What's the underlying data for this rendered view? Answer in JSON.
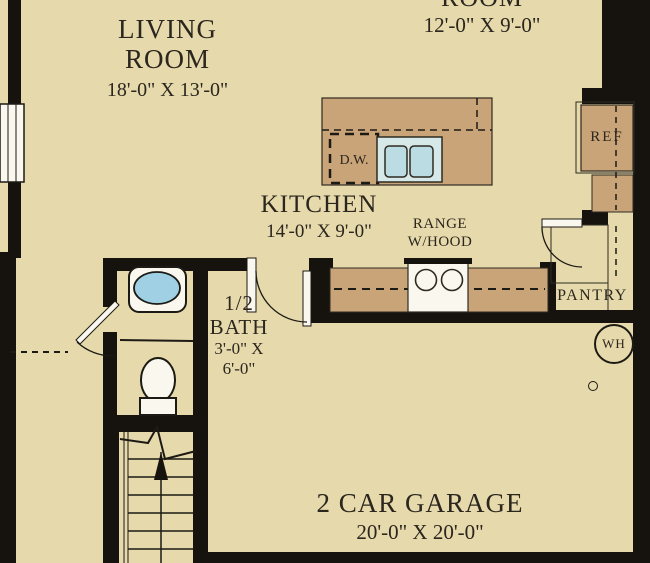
{
  "rooms": {
    "living_room": {
      "name_line1": "LIVING",
      "name_line2": "ROOM",
      "dimensions": "18'-0\" X 13'-0\""
    },
    "upper_room": {
      "name": "ROOM",
      "dimensions": "12'-0\" X 9'-0\""
    },
    "kitchen": {
      "name": "KITCHEN",
      "dimensions": "14'-0\" X 9'-0\""
    },
    "half_bath": {
      "name_line1": "1/2",
      "name_line2": "BATH",
      "dim_line1": "3'-0\" X",
      "dim_line2": "6'-0\""
    },
    "garage": {
      "name": "2 CAR GARAGE",
      "dimensions": "20'-0\" X 20'-0\""
    }
  },
  "fixtures": {
    "range": {
      "label_line1": "RANGE",
      "label_line2": "W/HOOD"
    },
    "dishwasher": {
      "label": "D.W."
    },
    "refrigerator": {
      "label": "REF"
    },
    "pantry": {
      "label": "PANTRY"
    },
    "water_heater": {
      "label": "WH"
    }
  },
  "colors": {
    "background": "#e6d9ab",
    "walls": "#16130f",
    "counters": "#c9a478",
    "sink_basin": "#bcdce4",
    "sink_surround": "#d6e8e8",
    "bath_sink": "#9fd0e4",
    "fixture_white": "#faf7ee",
    "text": "#2b261e"
  }
}
